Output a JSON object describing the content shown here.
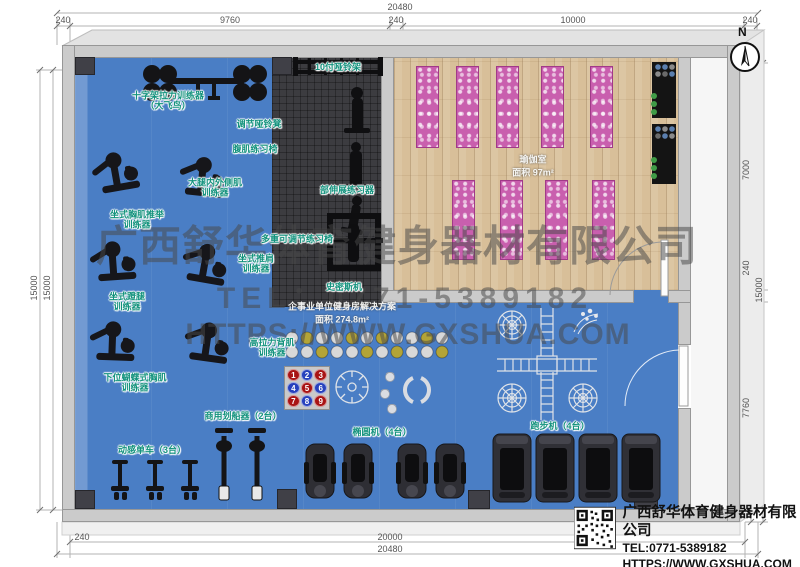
{
  "compass": {
    "label": "N"
  },
  "watermark": {
    "line1": "广西舒华体育健身器材有限公司",
    "line2": "TEL：0771-5389182",
    "line3": "HTTPS://WWW.GXSHUA.COM"
  },
  "dimensions": {
    "top_overall": "20480",
    "top_segments": [
      "240",
      "9760",
      "240",
      "10000",
      "240"
    ],
    "left_outer": "15000",
    "left_inner": "15000",
    "right_segments": [
      "7000",
      "240",
      "7760"
    ],
    "right_overall": "15000",
    "bottom_left": "240",
    "bottom_inner": "20000",
    "bottom_overall": "20480"
  },
  "rooms": {
    "yoga": "瑜伽室\n面积 97m²",
    "plan": "企事业单位健身房解决方案\n面积 274.8m²"
  },
  "labels": [
    {
      "text": "十字架拉力训练器\n（大飞鸟）"
    },
    {
      "text": "10付哑铃架"
    },
    {
      "text": "调节哑铃凳"
    },
    {
      "text": "腹肌练习椅"
    },
    {
      "text": "大腿内外侧肌\n训练器"
    },
    {
      "text": "部伸展练习器"
    },
    {
      "text": "坐式胸肌推举\n训练器"
    },
    {
      "text": "多重可调节练习椅"
    },
    {
      "text": "坐式推肩\n训练器"
    },
    {
      "text": "史密斯机"
    },
    {
      "text": "坐式蹬腿\n训练器"
    },
    {
      "text": "高拉力背肌\n训练器"
    },
    {
      "text": "下位蝴蝶式胸肌\n训练器"
    },
    {
      "text": "商用划船器（2台）"
    },
    {
      "text": "动感单车（3台）"
    },
    {
      "text": "椭圆机（4台）"
    },
    {
      "text": "跑步机（4台）"
    }
  ],
  "ball_rack": {
    "numbers": [
      "1",
      "2",
      "3",
      "4",
      "5",
      "6",
      "7",
      "8",
      "9"
    ],
    "colors": [
      "red",
      "blue",
      "red",
      "blue",
      "red",
      "blue",
      "red",
      "blue",
      "red"
    ]
  },
  "footer": {
    "company": "广西舒华体育健身器材有限公司",
    "tel": "TEL:0771-5389182",
    "url": "HTTPS://WWW.GXSHUA.COM"
  },
  "colors": {
    "floor_blue": "#4a7ec5",
    "floor_rubber": "#3c3c40",
    "floor_wood": "#d8bf99",
    "mat_pink": "#c95fae",
    "label_teal": "#13927d",
    "wall_gray": "#cbcbcb"
  }
}
